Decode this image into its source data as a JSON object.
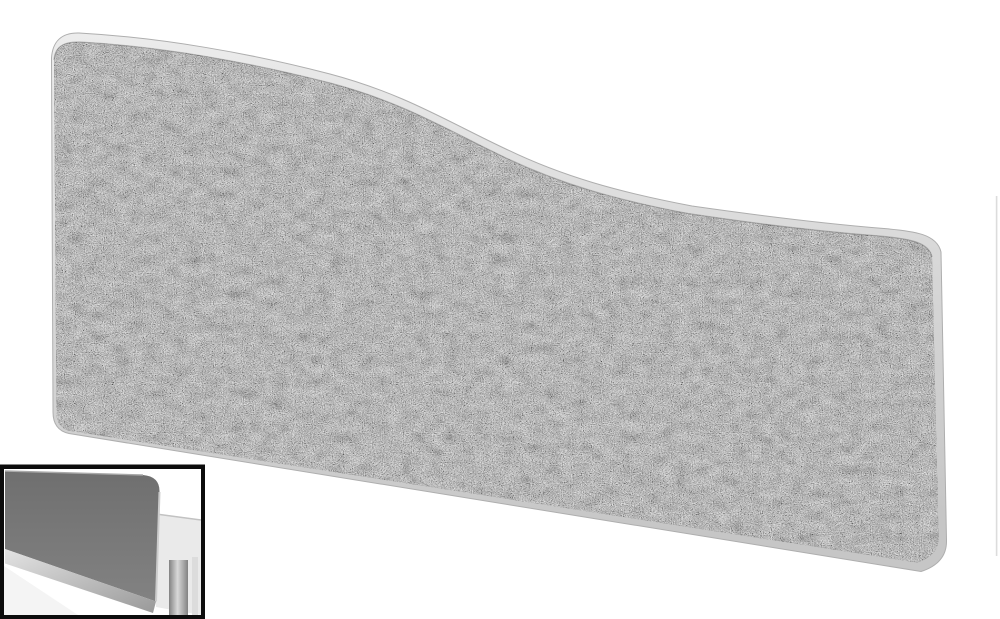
{
  "page": {
    "background_color": "#ffffff"
  },
  "main_image": {
    "label": "Wave-top acoustic desk screen, speckled grey tweed fabric with light grey rounded trim, high on the left sloping down to the right",
    "colors": {
      "trim_light": "#ececec",
      "trim_dark": "#c6c6c6",
      "trim_outline": "#aeaeae",
      "fabric_base": "#7a7a7a",
      "fabric_shadow_line": "#555555"
    }
  },
  "thumbnail": {
    "label": "In-situ view: grey screen mounted on rear edge of a white desk",
    "frame_color": "#0c0c0c",
    "background_color": "#ffffff",
    "colors": {
      "panel_top": "#6f6f6f",
      "panel_bottom": "#828282",
      "panel_top_edge": "#a9a9a9",
      "panel_right_edge": "#cccccc",
      "rail_light": "#e3e3e3",
      "rail_dark": "#999999",
      "desk_surface": "#eaeaea",
      "desk_edge_line": "#c2c2c2",
      "leg_outer": "#828282",
      "leg_center": "#d9d9d9",
      "leg_side_strip": "#dcdcdc",
      "front_wedge": "#f4f4f4"
    }
  },
  "side_artifact": {
    "label": "Edge sliver of adjacent gallery image at right border",
    "color": "#dcdcdc"
  }
}
